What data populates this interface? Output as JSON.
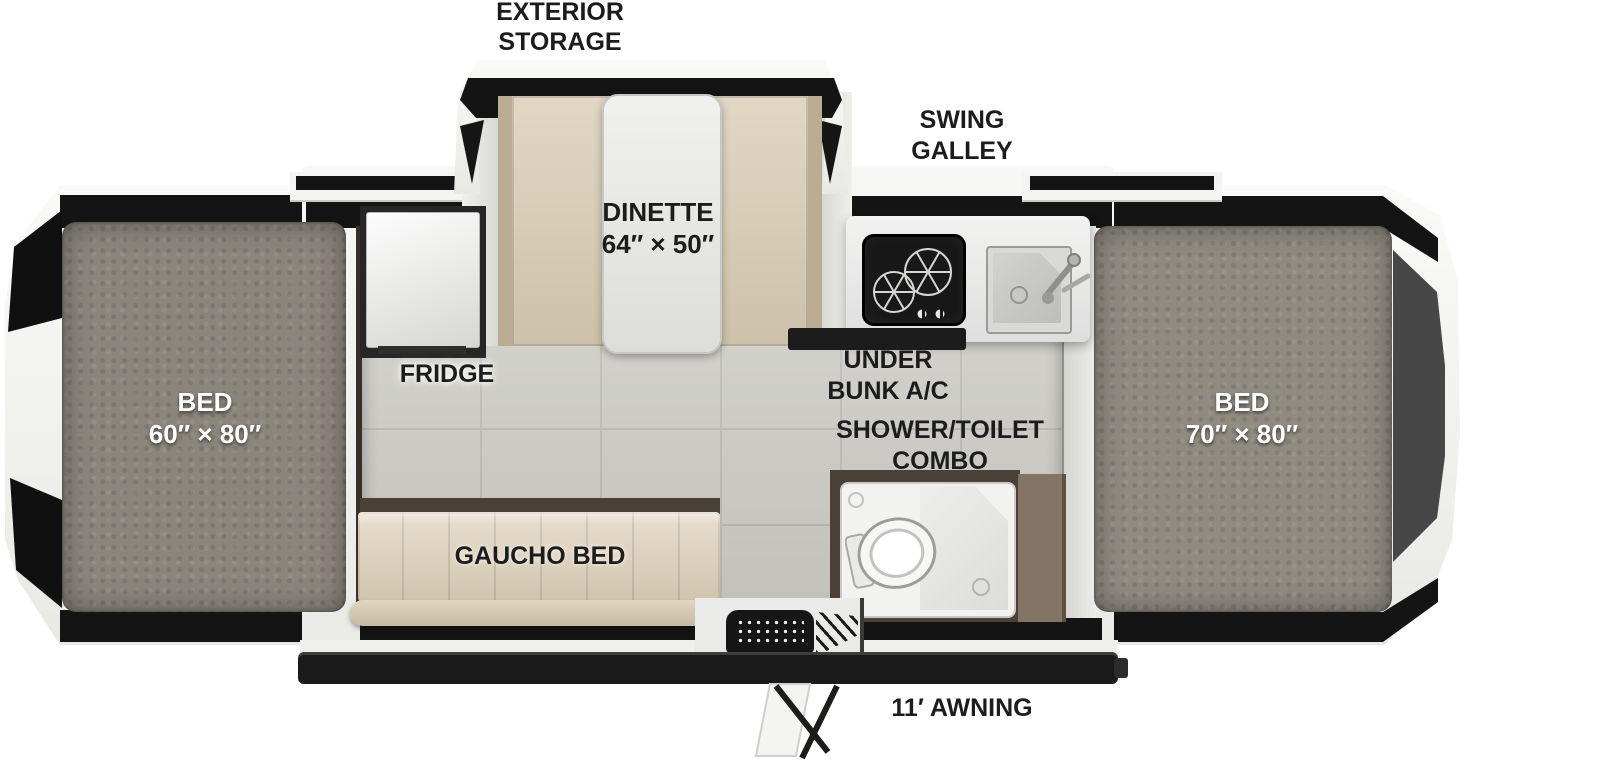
{
  "diagram_type": "rv-floorplan",
  "labels": {
    "exterior_storage": [
      "EXTERIOR",
      "STORAGE"
    ],
    "swing_galley": [
      "SWING",
      "GALLEY"
    ],
    "dinette": [
      "DINETTE",
      "64″ × 50″"
    ],
    "fridge": "FRIDGE",
    "under_bunk_ac": [
      "UNDER",
      "BUNK A/C"
    ],
    "shower_toilet": [
      "SHOWER/TOILET",
      "COMBO"
    ],
    "bed_left": [
      "BED",
      "60″ × 80″"
    ],
    "bed_right": [
      "BED",
      "70″ × 80″"
    ],
    "gaucho_bed": "GAUCHO BED",
    "awning": "11′ AWNING"
  },
  "colors": {
    "background": "#ffffff",
    "label_text": "#1c1c1c",
    "bed_label_text": "#ffffff",
    "body_shell": "#f2f2f0",
    "trim_black": "#141414",
    "mattress_gray": "#8b867c",
    "floor_tile": "#cdccc5",
    "cushion_tan": "#d9cdb8",
    "shower_wall_brown": "#6e5f52",
    "shower_pan": "#f2f2f1",
    "cooktop_black": "#181818",
    "sink_steel": "#c7c7c5"
  }
}
